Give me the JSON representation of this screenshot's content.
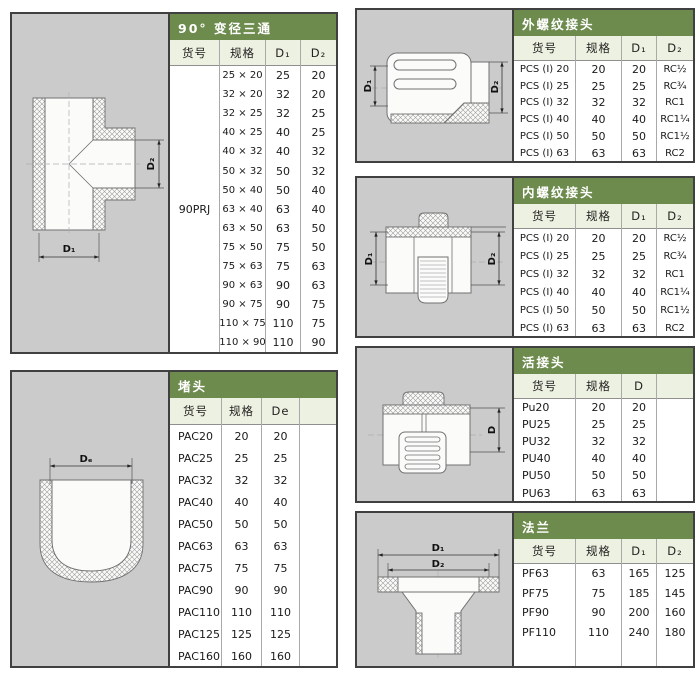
{
  "colors": {
    "header_green": "#6e8b4e",
    "subheader_bg": "#edf1e1",
    "panel_gray": "#cbcbcb",
    "border_dark": "#404040"
  },
  "sections": {
    "tee": {
      "title": "90° 变径三通",
      "columns": [
        "货号",
        "规格",
        "D₁",
        "D₂"
      ],
      "item_code": "90PRJ",
      "dim_labels": {
        "d1": "D₁",
        "d2": "D₂"
      },
      "rows": [
        {
          "spec": "25 × 20",
          "d1": "25",
          "d2": "20"
        },
        {
          "spec": "32 × 20",
          "d1": "32",
          "d2": "20"
        },
        {
          "spec": "32 × 25",
          "d1": "32",
          "d2": "25"
        },
        {
          "spec": "40 × 25",
          "d1": "40",
          "d2": "25"
        },
        {
          "spec": "40 × 32",
          "d1": "40",
          "d2": "32"
        },
        {
          "spec": "50 × 32",
          "d1": "50",
          "d2": "32"
        },
        {
          "spec": "50 × 40",
          "d1": "50",
          "d2": "40"
        },
        {
          "spec": "63 × 40",
          "d1": "63",
          "d2": "40"
        },
        {
          "spec": "63 × 50",
          "d1": "63",
          "d2": "50"
        },
        {
          "spec": "75 × 50",
          "d1": "75",
          "d2": "50"
        },
        {
          "spec": "75 × 63",
          "d1": "75",
          "d2": "63"
        },
        {
          "spec": "90 × 63",
          "d1": "90",
          "d2": "63"
        },
        {
          "spec": "90 × 75",
          "d1": "90",
          "d2": "75"
        },
        {
          "spec": "110 × 75",
          "d1": "110",
          "d2": "75"
        },
        {
          "spec": "110 × 90",
          "d1": "110",
          "d2": "90"
        }
      ]
    },
    "cap": {
      "title": "堵头",
      "columns": [
        "货号",
        "规格",
        "De",
        ""
      ],
      "dim_labels": {
        "de": "Dₑ"
      },
      "rows": [
        {
          "code": "PAC20",
          "spec": "20",
          "de": "20"
        },
        {
          "code": "PAC25",
          "spec": "25",
          "de": "25"
        },
        {
          "code": "PAC32",
          "spec": "32",
          "de": "32"
        },
        {
          "code": "PAC40",
          "spec": "40",
          "de": "40"
        },
        {
          "code": "PAC50",
          "spec": "50",
          "de": "50"
        },
        {
          "code": "PAC63",
          "spec": "63",
          "de": "63"
        },
        {
          "code": "PAC75",
          "spec": "75",
          "de": "75"
        },
        {
          "code": "PAC90",
          "spec": "90",
          "de": "90"
        },
        {
          "code": "PAC110",
          "spec": "110",
          "de": "110"
        },
        {
          "code": "PAC125",
          "spec": "125",
          "de": "125"
        },
        {
          "code": "PAC160",
          "spec": "160",
          "de": "160"
        }
      ]
    },
    "male": {
      "title": "外螺纹接头",
      "columns": [
        "货号",
        "规格",
        "D₁",
        "D₂"
      ],
      "dim_labels": {
        "d1": "D₁",
        "d2": "D₂"
      },
      "rows": [
        {
          "code": "PCS (I) 20",
          "spec": "20",
          "d1": "20",
          "d2": "RC½"
        },
        {
          "code": "PCS (I) 25",
          "spec": "25",
          "d1": "25",
          "d2": "RC¾"
        },
        {
          "code": "PCS (I) 32",
          "spec": "32",
          "d1": "32",
          "d2": "RC1"
        },
        {
          "code": "PCS (I) 40",
          "spec": "40",
          "d1": "40",
          "d2": "RC1¼"
        },
        {
          "code": "PCS (I) 50",
          "spec": "50",
          "d1": "50",
          "d2": "RC1½"
        },
        {
          "code": "PCS (I) 63",
          "spec": "63",
          "d1": "63",
          "d2": "RC2"
        }
      ]
    },
    "female": {
      "title": "内螺纹接头",
      "columns": [
        "货号",
        "规格",
        "D₁",
        "D₂"
      ],
      "dim_labels": {
        "d1": "D₁",
        "d2": "D₂"
      },
      "rows": [
        {
          "code": "PCS (I) 20",
          "spec": "20",
          "d1": "20",
          "d2": "RC½"
        },
        {
          "code": "PCS (I) 25",
          "spec": "25",
          "d1": "25",
          "d2": "RC¾"
        },
        {
          "code": "PCS (I) 32",
          "spec": "32",
          "d1": "32",
          "d2": "RC1"
        },
        {
          "code": "PCS (I) 40",
          "spec": "40",
          "d1": "40",
          "d2": "RC1¼"
        },
        {
          "code": "PCS (I) 50",
          "spec": "50",
          "d1": "50",
          "d2": "RC1½"
        },
        {
          "code": "PCS (I) 63",
          "spec": "63",
          "d1": "63",
          "d2": "RC2"
        }
      ]
    },
    "union": {
      "title": "活接头",
      "columns": [
        "货号",
        "规格",
        "D",
        ""
      ],
      "dim_labels": {
        "d": "D"
      },
      "rows": [
        {
          "code": "Pu20",
          "spec": "20",
          "d": "20"
        },
        {
          "code": "PU25",
          "spec": "25",
          "d": "25"
        },
        {
          "code": "PU32",
          "spec": "32",
          "d": "32"
        },
        {
          "code": "PU40",
          "spec": "40",
          "d": "40"
        },
        {
          "code": "PU50",
          "spec": "50",
          "d": "50"
        },
        {
          "code": "PU63",
          "spec": "63",
          "d": "63"
        }
      ]
    },
    "flange": {
      "title": "法兰",
      "columns": [
        "货号",
        "规格",
        "D₁",
        "D₂"
      ],
      "dim_labels": {
        "d1": "D₁",
        "d2": "D₂"
      },
      "rows": [
        {
          "code": "PF63",
          "spec": "63",
          "d1": "165",
          "d2": "125"
        },
        {
          "code": "PF75",
          "spec": "75",
          "d1": "185",
          "d2": "145"
        },
        {
          "code": "PF90",
          "spec": "90",
          "d1": "200",
          "d2": "160"
        },
        {
          "code": "PF110",
          "spec": "110",
          "d1": "240",
          "d2": "180"
        }
      ]
    }
  }
}
